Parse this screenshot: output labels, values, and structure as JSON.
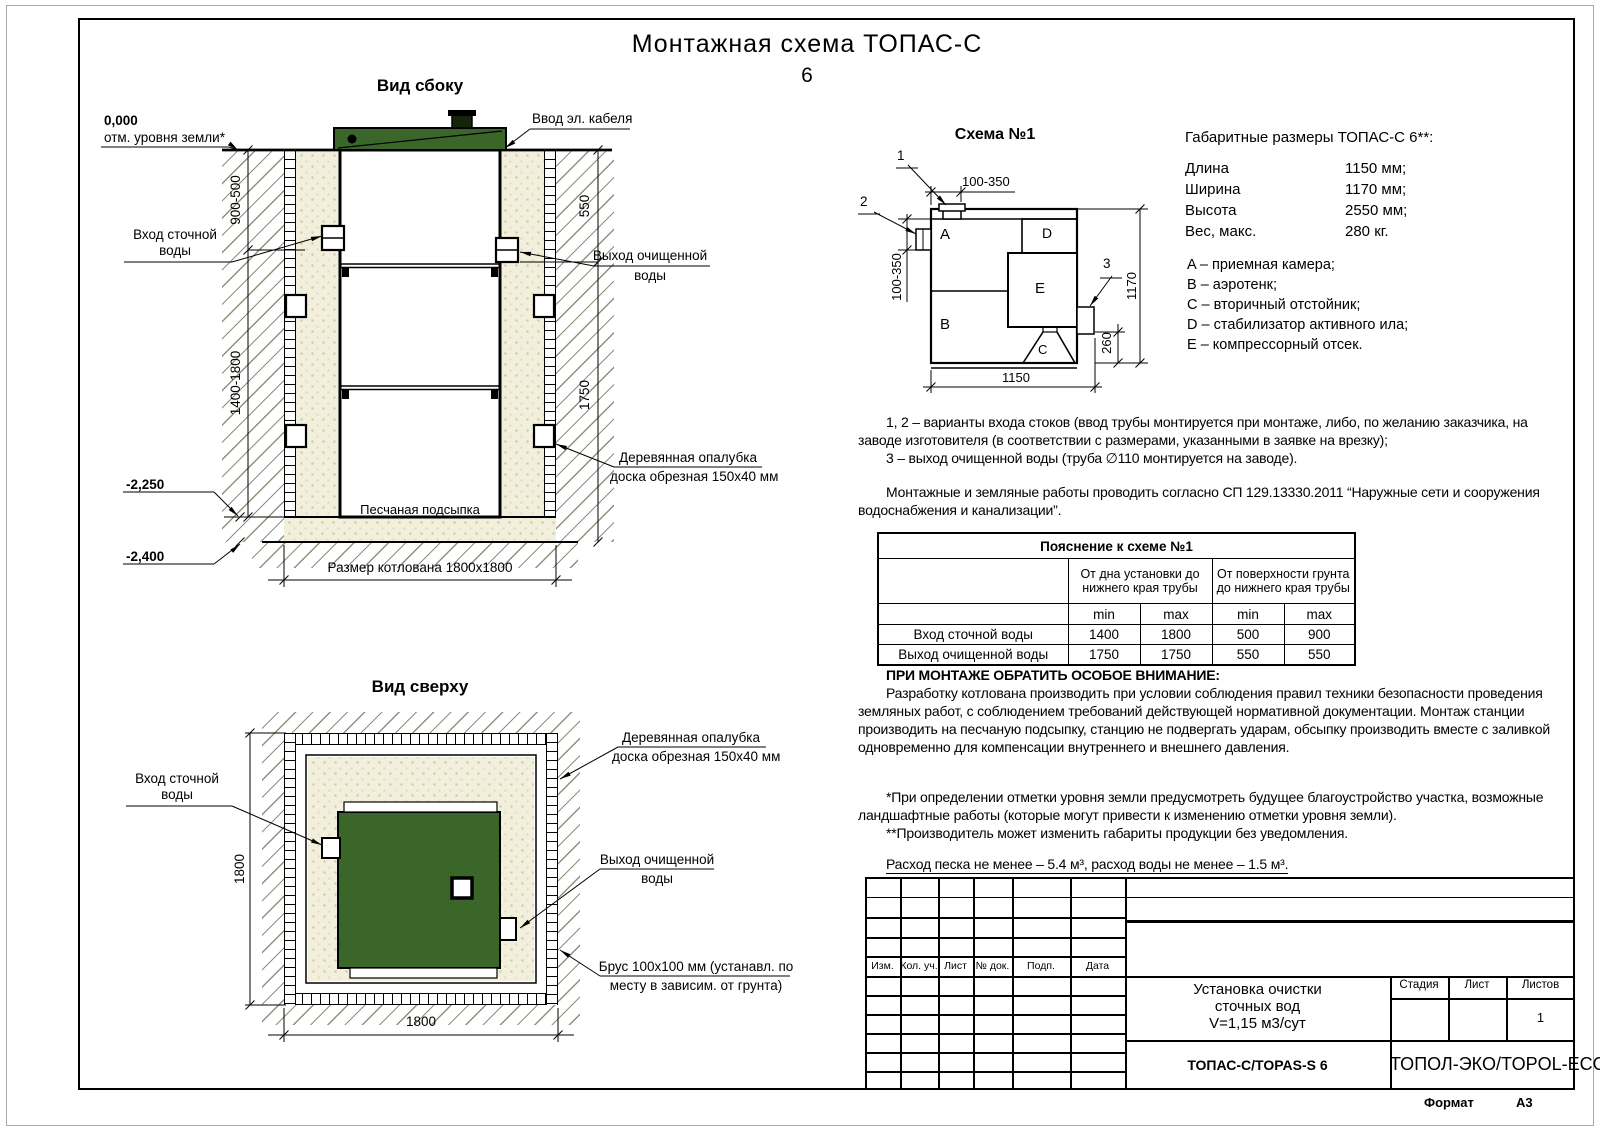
{
  "page": {
    "title_line1": "Монтажная схема ТОПАС-С",
    "title_line2": "6",
    "format_label": "Формат",
    "format_value": "А3"
  },
  "side_view": {
    "title": "Вид сбоку",
    "zero_mark": "0,000",
    "ground_label": "отм. уровня земли*",
    "cable_label": "Ввод эл. кабеля",
    "inlet_l1": "Вход сточной",
    "inlet_l2": "воды",
    "outlet_l1": "Выход очищенной",
    "outlet_l2": "воды",
    "formwork_l1": "Деревянная опалубка",
    "formwork_l2": "доска обрезная 150х40 мм",
    "sand_label": "Песчаная подсыпка",
    "pit_label": "Размер котлована 1800х1800",
    "lvl_2250": "-2,250",
    "lvl_2400": "-2,400",
    "dim_depth_top": "900-500",
    "dim_depth_main": "1400-1800",
    "dim_out_top": "550",
    "dim_out_main": "1750"
  },
  "top_view": {
    "title": "Вид сверху",
    "inlet_l1": "Вход сточной",
    "inlet_l2": "воды",
    "outlet_l1": "Выход очищенной",
    "outlet_l2": "воды",
    "formwork_l1": "Деревянная опалубка",
    "formwork_l2": "доска обрезная 150х40 мм",
    "beam_l1": "Брус 100х100 мм (устанавл. по",
    "beam_l2": "месту в зависим. от грунта)",
    "dim_w": "1800",
    "dim_h": "1800"
  },
  "schema": {
    "title": "Схема №1",
    "comp_a": "A",
    "comp_b": "B",
    "comp_c": "C",
    "comp_d": "D",
    "comp_e": "E",
    "mark_1": "1",
    "mark_2": "2",
    "mark_3": "3",
    "dim_top": "100-350",
    "dim_left": "100-350",
    "dim_height": "1170",
    "dim_outlet": "260",
    "dim_length": "1150"
  },
  "dimensions": {
    "title": "Габаритные размеры ТОПАС-С 6**:",
    "rows": [
      {
        "label": "Длина",
        "value": "1150 мм;"
      },
      {
        "label": "Ширина",
        "value": "1170 мм;"
      },
      {
        "label": "Высота",
        "value": "2550 мм;"
      },
      {
        "label": "Вес, макс.",
        "value": "280 кг."
      }
    ],
    "legend": [
      "A – приемная камера;",
      "B – аэротенк;",
      "C – вторичный отстойник;",
      "D – стабилизатор активного ила;",
      "E – компрессорный отсек."
    ]
  },
  "notes": {
    "variants_l1": "1, 2 – варианты входа стоков (ввод трубы монтируется при монтаже, либо, по желанию заказчика, на",
    "variants_l2": "заводе изготовителя (в соответствии с размерами, указанными в заявке на врезку);",
    "variants_l3": "3 – выход очищенной воды (труба ∅110 монтируется на заводе).",
    "works_l1": "Монтажные и земляные работы проводить согласно СП 129.13330.2011 “Наружные сети и сооружения",
    "works_l2": "водоснабжения и канализации”.",
    "attention_title": "ПРИ МОНТАЖЕ ОБРАТИТЬ ОСОБОЕ ВНИМАНИЕ:",
    "attention_l1": "Разработку котлована производить при условии соблюдения правил техники безопасности проведения",
    "attention_l2": "земляных работ, с соблюдением требований действующей нормативной документации. Монтаж станции",
    "attention_l3": "производить на песчаную подсыпку, станцию не подвергать ударам, обсыпку производить вместе с заливкой",
    "attention_l4": "одновременно для компенсации внутреннего и внешнего давления.",
    "footnote_l1": "*При определении отметки уровня земли предусмотреть будущее благоустройство участка, возможные",
    "footnote_l2": "ландшафтные работы (которые могут привести к изменению отметки уровня земли).",
    "footnote_l3": "**Производитель может изменить габариты продукции без уведомления.",
    "consumption": "Расход песка не менее – 5.4 м³, расход воды не менее – 1.5 м³."
  },
  "explain_table": {
    "title": "Пояснение к схеме №1",
    "group1_l1": "От дна установки до",
    "group1_l2": "нижнего края трубы",
    "group2_l1": "От поверхности грунта",
    "group2_l2": "до нижнего края трубы",
    "min": "min",
    "max": "max",
    "rows": [
      {
        "name": "Вход сточной воды",
        "v1": "1400",
        "v2": "1800",
        "v3": "500",
        "v4": "900"
      },
      {
        "name": "Выход очищенной воды",
        "v1": "1750",
        "v2": "1750",
        "v3": "550",
        "v4": "550"
      }
    ]
  },
  "title_block": {
    "cols": [
      "Изм.",
      "Кол. уч.",
      "Лист",
      "№ док.",
      "Подп.",
      "Дата"
    ],
    "doc_l1": "Установка очистки",
    "doc_l2": "сточных вод",
    "doc_l3": "V=1,15 м3/сут",
    "stage": "Стадия",
    "sheet": "Лист",
    "sheets": "Листов",
    "sheets_value": "1",
    "model": "ТОПАС-С/TOPAS-S 6",
    "company": "ТОПОЛ-ЭКО/TOPOL-ECO"
  }
}
